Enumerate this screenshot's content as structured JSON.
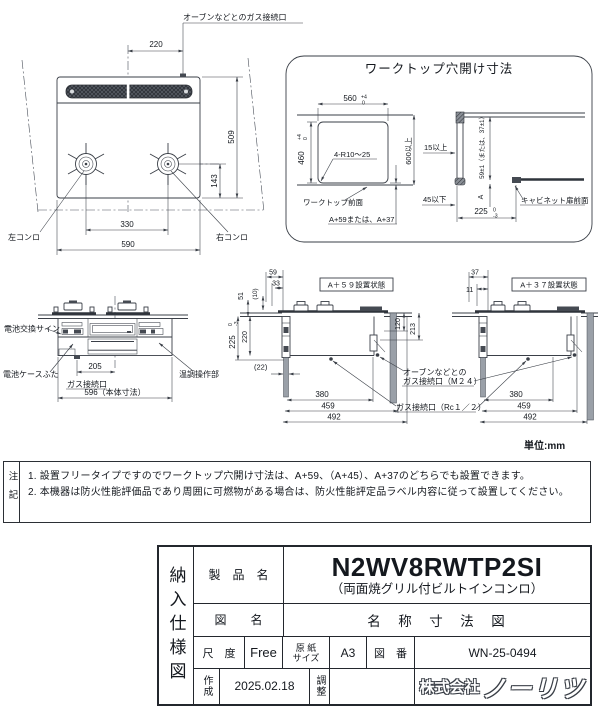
{
  "page": {
    "unit_label": "単位:mm"
  },
  "top_view": {
    "oven_gas_label": "オーブンなどとのガス接続口",
    "left_burner": "左コンロ",
    "right_burner": "右コンロ",
    "dim_220": "220",
    "dim_509": "509",
    "dim_143": "143",
    "dim_330": "330",
    "dim_590": "590"
  },
  "worktop_box": {
    "title": "ワークトップ穴開け寸法",
    "dim_560": "560",
    "tol_560_hi": "+4",
    "tol_560_lo": "0",
    "dim_460": "460",
    "tol_460_hi": "+4",
    "tol_460_lo": "0",
    "corner_r": "4-R10～25",
    "dim_600": "600以上",
    "worktop_front": "ワークトップ前面",
    "a_options": "A+59または、A+37",
    "min_15": "15以上",
    "max_45": "45以下",
    "dim_59pm": "59±1（または、37±1）",
    "dim_a": "A",
    "dim_225": "225",
    "tol_225_hi": "0",
    "tol_225_lo": "-3",
    "cabinet_front": "キャビネット扉前面"
  },
  "front_view": {
    "battery_sign": "電池交換サイン",
    "battery_lid": "電池ケースふた",
    "gas_port": "ガス接続口",
    "temp_control": "温調操作部",
    "dim_205": "205",
    "dim_596": "596（本体寸法）"
  },
  "side_a59": {
    "title": "A＋５９設置状態",
    "dim_59": "59",
    "dim_33": "33",
    "dim_10": "(10)",
    "dim_51": "51",
    "dim_220": "220",
    "dim_225": "225",
    "tol_225_hi": "0",
    "tol_225_lo": "-3",
    "dim_22": "(22)",
    "dim_120": "120",
    "dim_213": "213",
    "dim_380": "380",
    "dim_459": "459",
    "dim_492": "492"
  },
  "side_a37": {
    "title": "A＋３７設置状態",
    "dim_37": "37",
    "dim_11": "11",
    "dim_380": "380",
    "dim_459": "459",
    "dim_492": "492"
  },
  "connections": {
    "oven_gas_line1": "オーブンなどとの",
    "oven_gas_line2": "ガス接続口（M２４）",
    "gas_rc": "ガス接続口（Rc１／２）"
  },
  "notes": {
    "header": "注記",
    "items": [
      "1. 設置フリータイプですのでワークトップ穴開け寸法は、A+59、（A+45）、A+37のどちらでも設置できます。",
      "2. 本機器は防火性能評価品であり周囲に可燃物がある場合は、防火性能評定品ラベル内容に従って設置してください。"
    ]
  },
  "title_block": {
    "doc_type": "納入仕様図",
    "product_label": "製　品　名",
    "product_name": "N2WV8RWTP2SI",
    "product_desc": "（両面焼グリル付ビルトインコンロ）",
    "drawing_label": "図　　名",
    "drawing_name": "名　称　寸　法　図",
    "scale_label": "尺　度",
    "scale_value": "Free",
    "paper_label_1": "原 紙",
    "paper_label_2": "サイズ",
    "paper_value": "A3",
    "number_label": "図　番",
    "number_value": "WN-25-0494",
    "created_label": "作成",
    "created_value": "2025.02.18",
    "adjust_label": "調整",
    "company_prefix": "株式会社",
    "company_name": "ノーリツ"
  }
}
